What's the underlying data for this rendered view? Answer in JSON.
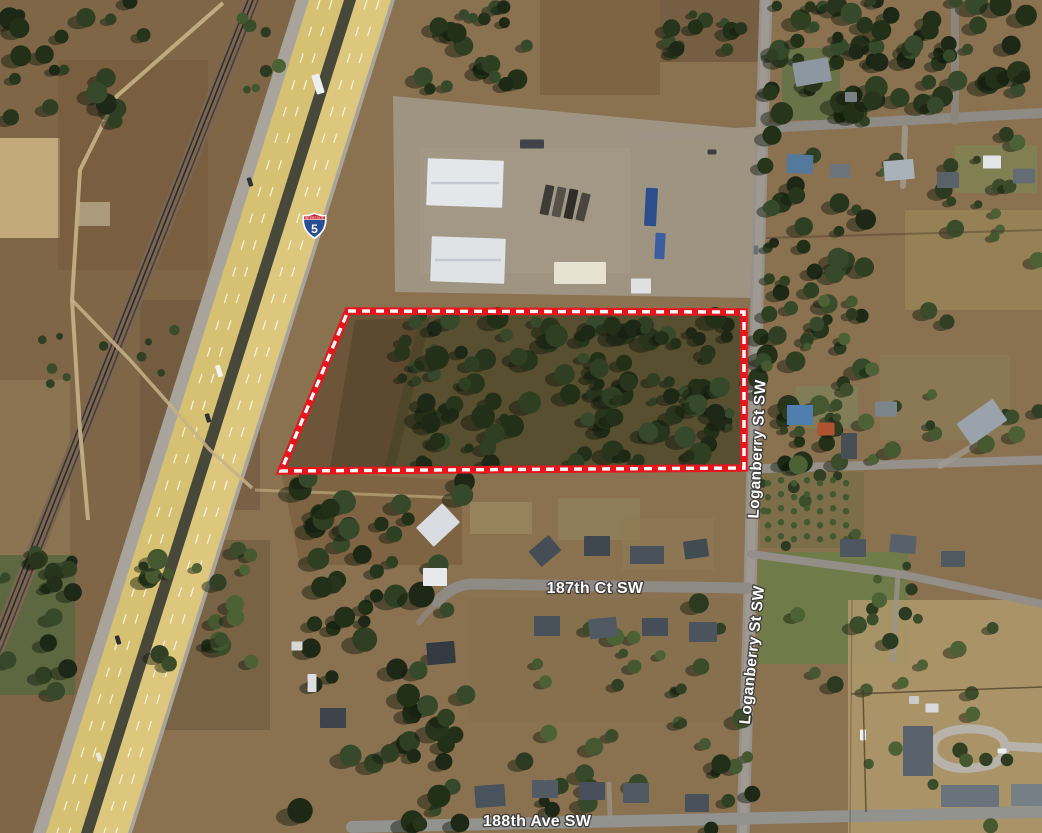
{
  "map": {
    "kind": "aerial imagery with parcel annotation",
    "shield": {
      "banner": "INTERSTATE",
      "route": "5"
    },
    "streets": {
      "loganberry_north": "Loganberry St SW",
      "loganberry_south": "Loganberry St SW",
      "court_187th": "187th Ct SW",
      "ave_188th": "188th Ave SW"
    },
    "annotation": {
      "label": "parcel boundary",
      "style": "dashed",
      "line_color": "#e8151c",
      "dash_color": "#ffffff"
    },
    "palette": {
      "highway_pavement": "#d9c478",
      "forest_dark": "#27351c",
      "field_brown": "#8a7150",
      "road_gray": "#96918a"
    }
  }
}
